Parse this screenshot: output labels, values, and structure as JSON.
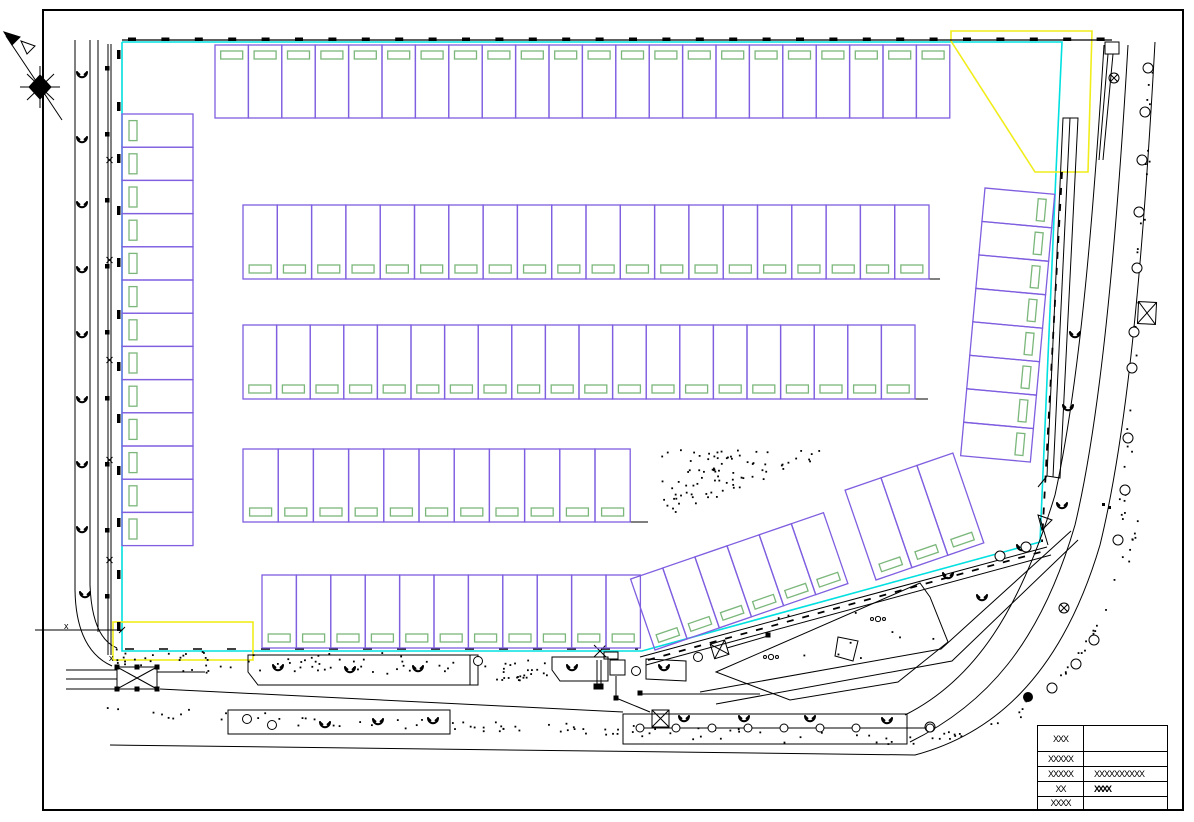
{
  "sheet": {
    "width": 1194,
    "height": 822,
    "kind": "parking site plan"
  },
  "palette": {
    "boundary_cyan": "#00e0e0",
    "zone_yellow": "#f0ed1a",
    "stall_purple": "#7f5ee0",
    "marking_green": "#7bb77b",
    "ink_black": "#000000",
    "paper_white": "#ffffff"
  },
  "symbols": {
    "north-arrow-icon": "compass star with northwest arrow",
    "tree-icon": "shrub glyph (open curl)",
    "street-tree-icon": "open circle",
    "crossed-box-icon": "rectangle with X",
    "circle-cross-icon": "circle with X",
    "stipple": "landscape dot hatch"
  },
  "parking": {
    "rows": [
      {
        "name": "north-row",
        "orient": "v",
        "x": 215,
        "y": 45,
        "stall_w": 33.4,
        "stall_h": 73,
        "count": 22,
        "mark": "top"
      },
      {
        "name": "west-column",
        "orient": "h",
        "x": 122,
        "y": 114,
        "stall_w": 71,
        "stall_h": 33.2,
        "count": 13,
        "mark": "left"
      },
      {
        "name": "mid-row-1",
        "orient": "v",
        "x": 243,
        "y": 205,
        "stall_w": 34.3,
        "stall_h": 74,
        "count": 20,
        "mark": "bottom"
      },
      {
        "name": "mid-row-2",
        "orient": "v",
        "x": 243,
        "y": 325,
        "stall_w": 33.6,
        "stall_h": 74,
        "count": 20,
        "mark": "bottom"
      },
      {
        "name": "mid-row-3",
        "orient": "v",
        "x": 243,
        "y": 449,
        "stall_w": 35.2,
        "stall_h": 73,
        "count": 11,
        "mark": "bottom"
      },
      {
        "name": "south-row",
        "orient": "v",
        "x": 262,
        "y": 575,
        "stall_w": 34.4,
        "stall_h": 73,
        "count": 11,
        "mark": "bottom"
      },
      {
        "name": "east-column",
        "orient": "h",
        "x": 0,
        "y": 0,
        "tx": 985,
        "ty": 188,
        "rot": 5.2,
        "stall_w": 70,
        "stall_h": 33.6,
        "count": 8,
        "mark": "right"
      },
      {
        "name": "southeast-diagonal-a",
        "orient": "v",
        "x": 0,
        "y": -75,
        "tx": 655,
        "ty": 650,
        "rot": -19,
        "stall_w": 34,
        "stall_h": 75,
        "count": 6,
        "mark": "bottom"
      },
      {
        "name": "southeast-diagonal-b",
        "orient": "v",
        "x": 0,
        "y": -95,
        "tx": 876,
        "ty": 580,
        "rot": -19,
        "stall_w": 38,
        "stall_h": 95,
        "count": 3,
        "mark": "bottom"
      }
    ]
  },
  "landscape": {
    "tree_glyphs": [
      [
        82,
        75
      ],
      [
        82,
        140
      ],
      [
        82,
        205
      ],
      [
        82,
        270
      ],
      [
        82,
        335
      ],
      [
        82,
        400
      ],
      [
        82,
        465
      ],
      [
        82,
        530
      ],
      [
        85,
        595
      ],
      [
        278,
        668
      ],
      [
        350,
        670
      ],
      [
        418,
        669
      ],
      [
        572,
        668
      ],
      [
        664,
        668
      ],
      [
        684,
        719
      ],
      [
        744,
        719
      ],
      [
        810,
        719
      ],
      [
        887,
        721
      ],
      [
        325,
        725
      ],
      [
        378,
        722
      ],
      [
        433,
        721
      ],
      [
        1075,
        335
      ],
      [
        1068,
        408
      ],
      [
        1062,
        506
      ],
      [
        1022,
        548
      ],
      [
        982,
        598
      ],
      [
        948,
        576
      ]
    ],
    "street_tree_circles": [
      [
        1148,
        68
      ],
      [
        1145,
        112
      ],
      [
        1142,
        160
      ],
      [
        1139,
        212
      ],
      [
        1137,
        268
      ],
      [
        1134,
        332
      ],
      [
        1132,
        368
      ],
      [
        1128,
        438
      ],
      [
        1125,
        490
      ],
      [
        1118,
        540
      ],
      [
        1094,
        640
      ],
      [
        1076,
        664
      ],
      [
        1052,
        688
      ],
      [
        930,
        727
      ],
      [
        1000,
        556
      ],
      [
        1026,
        547
      ]
    ],
    "filled_circle": [
      1028,
      697
    ],
    "bollard_circles_y": 728,
    "bollard_circles_x": [
      640,
      676,
      712,
      748,
      784,
      820,
      856,
      930
    ],
    "misc_circles": [
      [
        478,
        661
      ],
      [
        698,
        657
      ],
      [
        636,
        671
      ],
      [
        247,
        719
      ],
      [
        272,
        725
      ]
    ],
    "stipple_zones": [
      {
        "shape": "tri",
        "pts": [
          [
            660,
            448
          ],
          [
            840,
            450
          ],
          [
            662,
            517
          ]
        ],
        "n": 85
      },
      {
        "shape": "rect",
        "x": 162,
        "y": 651,
        "w": 295,
        "h": 22,
        "n": 55
      },
      {
        "shape": "rect",
        "x": 483,
        "y": 656,
        "w": 64,
        "h": 24,
        "n": 26
      },
      {
        "shape": "rect",
        "x": 770,
        "y": 608,
        "w": 180,
        "h": 55,
        "n": 10
      },
      {
        "shape": "rect",
        "x": 112,
        "y": 648,
        "w": 45,
        "h": 18,
        "n": 12
      },
      {
        "shape": "band",
        "pts": [
          [
            112,
            712
          ],
          [
            898,
            740
          ]
        ],
        "n": 80,
        "j": 6
      },
      {
        "shape": "band",
        "pts": [
          [
            898,
            744
          ],
          [
            1005,
            722
          ],
          [
            1065,
            672
          ],
          [
            1112,
            598
          ],
          [
            1140,
            520
          ]
        ],
        "n": 42,
        "j": 5
      },
      {
        "shape": "band",
        "pts": [
          [
            1150,
            60
          ],
          [
            1133,
            400
          ],
          [
            1120,
            520
          ]
        ],
        "n": 30,
        "j": 4
      }
    ],
    "fence_posts": [
      [
        107,
        68
      ],
      [
        107,
        134
      ],
      [
        107,
        200
      ],
      [
        107,
        266
      ],
      [
        107,
        332
      ],
      [
        107,
        398
      ],
      [
        107,
        464
      ],
      [
        107,
        530
      ],
      [
        107,
        596
      ]
    ],
    "fence_x_marks_y": [
      160,
      260,
      360,
      460,
      560
    ],
    "dot_pair": [
      [
        1102,
        503
      ],
      [
        1108,
        506
      ]
    ],
    "triple_dots": [
      [
        878,
        619
      ],
      [
        771,
        657
      ]
    ]
  },
  "boundary": {
    "cyan_polyline": [
      [
        122,
        42
      ],
      [
        1062,
        42
      ],
      [
        1056,
        172
      ],
      [
        1040,
        542
      ],
      [
        642,
        651
      ],
      [
        122,
        651
      ],
      [
        122,
        42
      ]
    ],
    "yellow_corner_polygon": [
      [
        951,
        31
      ],
      [
        1092,
        31
      ],
      [
        1088,
        172
      ],
      [
        1035,
        172
      ],
      [
        951,
        41
      ]
    ],
    "yellow_entry_rect": {
      "x": 113,
      "y": 622,
      "w": 140,
      "h": 38
    },
    "top_dashes": {
      "x0": 128,
      "x1": 1100,
      "step": 33.4,
      "y": 37.5,
      "w": 8,
      "h": 3.5
    },
    "left_dashes": {
      "y0": 50,
      "y1": 640,
      "step": 52,
      "x": 117,
      "w": 3.5,
      "h": 9
    }
  },
  "annotations": {
    "x_labels": [
      {
        "text": "x",
        "x": 64,
        "y": 629
      },
      {
        "text": "x",
        "x": 109,
        "y": 661
      }
    ]
  },
  "title_block": {
    "rows": [
      {
        "label": "XXX",
        "value": ""
      },
      {
        "label": "XXXXX",
        "value": ""
      },
      {
        "label": "XXXXX",
        "value": "XXXXXXXXXX"
      },
      {
        "label": "XX",
        "value": "XXXX"
      },
      {
        "label": "XXXX",
        "value": ""
      }
    ]
  }
}
